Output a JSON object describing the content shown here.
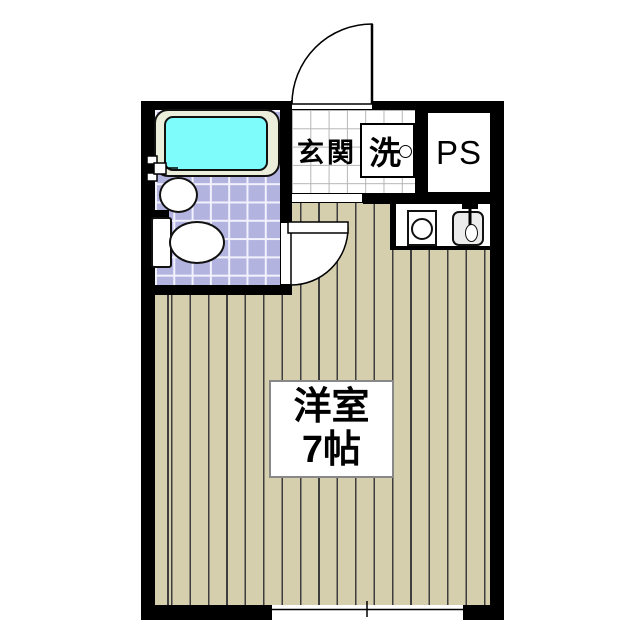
{
  "plan": {
    "title": "studio-apartment-floor-plan",
    "rooms": {
      "entrance": {
        "label": "玄関"
      },
      "laundry": {
        "label": "洗"
      },
      "pipe_space": {
        "label": "PS"
      },
      "main_room": {
        "name": "洋室",
        "size": "7帖"
      }
    },
    "fixtures": [
      "bathtub",
      "wash-basin",
      "toilet",
      "washing-machine-space",
      "kitchen-burner",
      "kitchen-sink",
      "entrance-door",
      "bathroom-door",
      "window"
    ],
    "colors": {
      "wall": "#000000",
      "floor": "#d5cfad",
      "floor_stripe": "#3e3e3e",
      "bath_tile": "#b3b3e0",
      "bath_tile_grid": "#f2f2ff",
      "bathtub_water": "#7efcfc",
      "bathtub_rim": "#ebeedb",
      "genkan_grid": "#b5b5b5",
      "label_border": "#888888"
    }
  }
}
